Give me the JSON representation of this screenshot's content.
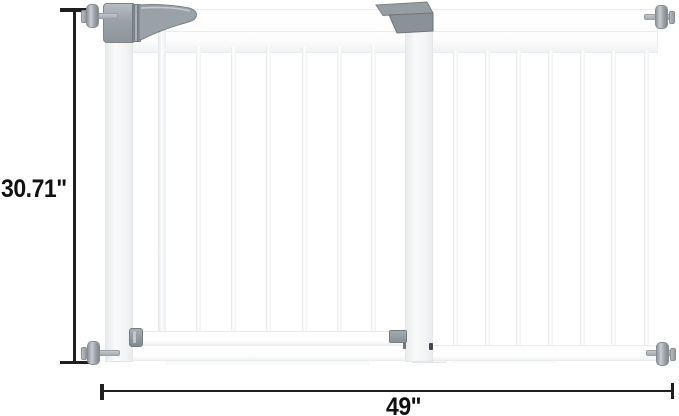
{
  "diagram": {
    "type": "product-dimension-diagram",
    "subject": "white pressure-mounted baby safety gate with walk-through door and extension panel",
    "height_dimension": {
      "label": "30.71\""
    },
    "width_dimension": {
      "label": "49\""
    }
  },
  "gate": {
    "door_section_bar_count": 7,
    "extension_section_bar_count": 7,
    "hardware": [
      "pressure-spindle-top-left",
      "pressure-spindle-top-right",
      "pressure-spindle-bottom-left",
      "pressure-spindle-bottom-right",
      "handle-lock-assembly",
      "extension-latch",
      "door-bottom-hinge",
      "door-bottom-latch"
    ],
    "colors": {
      "gate_frame": "#ffffff",
      "frame_shading": "#eaecee",
      "hardware_gray": "#949ba1",
      "hardware_gray_dark": "#757c82",
      "dimension_line": "#1f1f1f",
      "label_text": "#101010"
    }
  }
}
